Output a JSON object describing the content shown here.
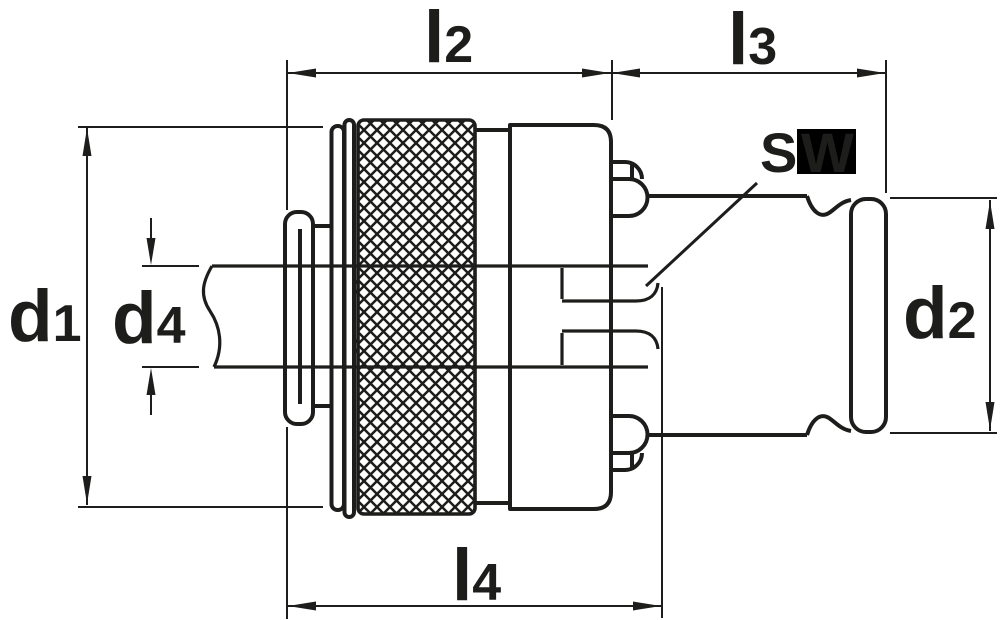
{
  "colors": {
    "line": "#1d1d1b",
    "background": "#ffffff",
    "sw_highlight_bg": "#000000",
    "sw_highlight_text": "#2e2e2e"
  },
  "labels": {
    "l2": {
      "main": "l",
      "sub": "2"
    },
    "l3": {
      "main": "l",
      "sub": "3"
    },
    "l4": {
      "main": "l",
      "sub": "4"
    },
    "d1": {
      "main": "d",
      "sub": "1"
    },
    "d2": {
      "main": "d",
      "sub": "2"
    },
    "d4": {
      "main": "d",
      "sub": "4"
    },
    "sw": {
      "s": "S",
      "w": "W"
    }
  }
}
